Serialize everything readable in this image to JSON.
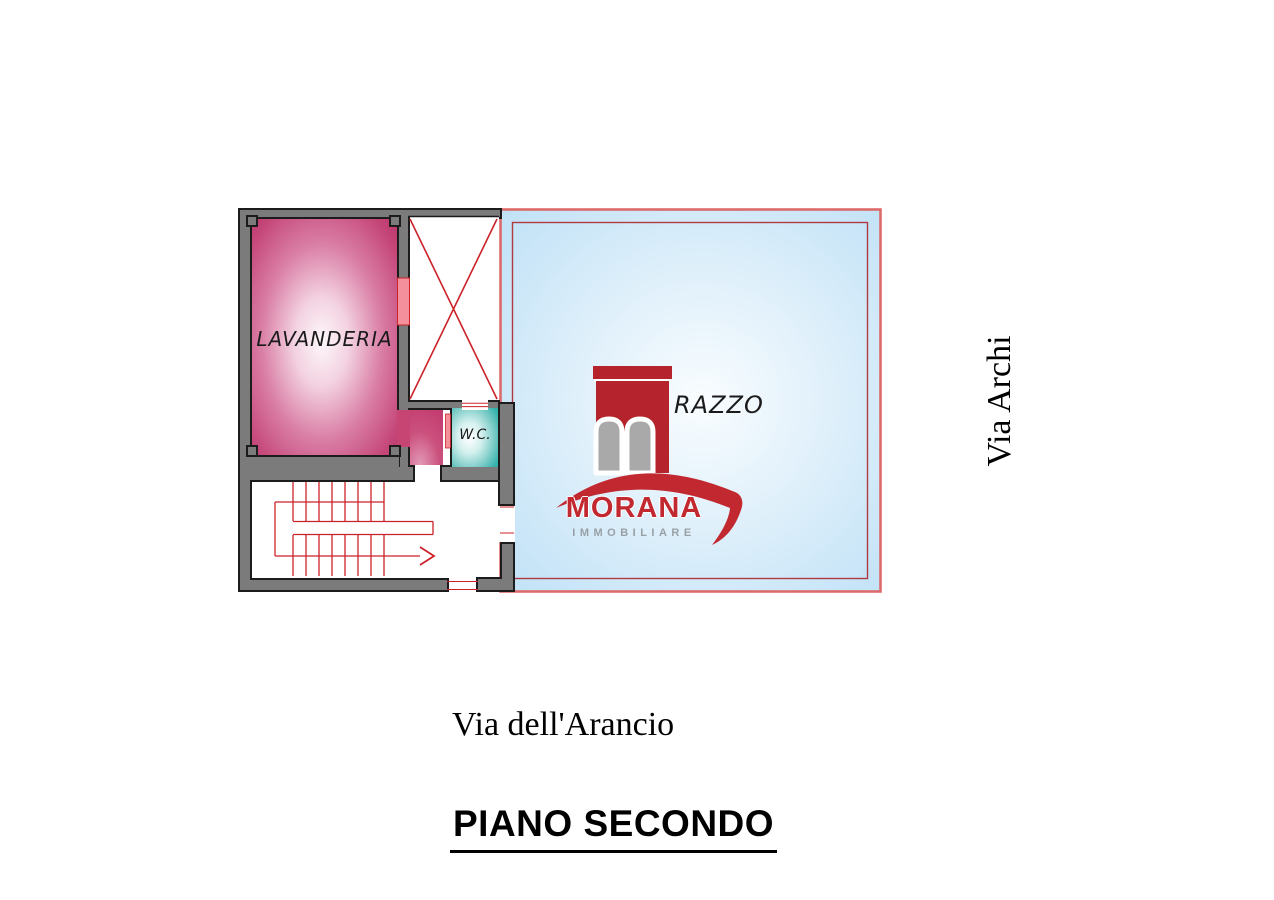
{
  "title": "PIANO SECONDO",
  "streets": {
    "right": "Via Archi",
    "bottom": "Via dell'Arancio"
  },
  "rooms": {
    "lavanderia": {
      "label": "LAVANDERIA",
      "fill": "#bd3168"
    },
    "wc": {
      "label": "W.C.",
      "fill": "#2fb0a9"
    },
    "terrace": {
      "visible_label": "RAZZO",
      "fill": "#bfe1f6"
    }
  },
  "watermark": {
    "brand": "MORANA",
    "tagline": "IMMOBILIARE"
  },
  "colors": {
    "wall_gray": "#7b7b7b",
    "outline_black": "#1c1c1c",
    "plan_red": "#cc2229",
    "window_pink": "#f4909c",
    "terrace_border_outer": "#dd6a6a",
    "terrace_border_inner": "#b03a42",
    "logo_red": "#b5242c",
    "logo_swoosh_red": "#c2282f",
    "logo_arch_gray": "#a9a9a9",
    "logo_text_gray": "#98a0a6"
  }
}
